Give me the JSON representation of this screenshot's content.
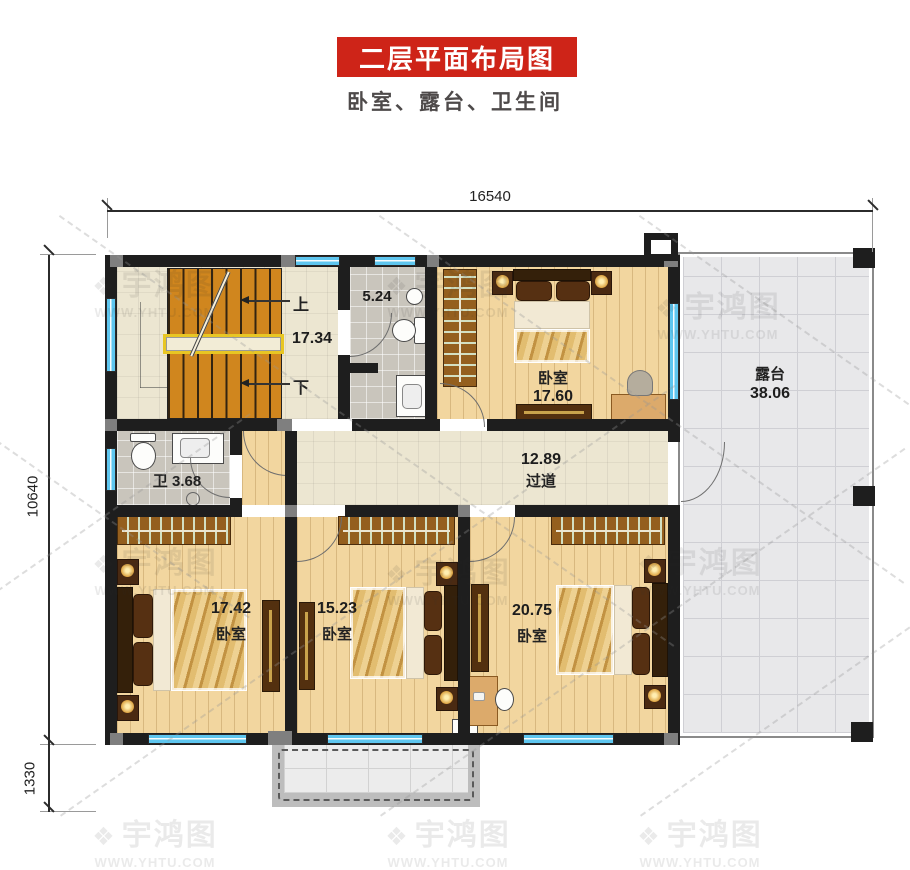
{
  "header": {
    "title": "二层平面布局图",
    "subtitle": "卧室、露台、卫生间"
  },
  "dimensions": {
    "top_width": "16540",
    "left_height_main": "10640",
    "left_height_lower": "1330"
  },
  "stairs": {
    "area": "17.34",
    "up_label": "上",
    "down_label": "下"
  },
  "bath_top": {
    "area": "5.24"
  },
  "bedroom_top": {
    "name": "卧室",
    "area": "17.60"
  },
  "terrace": {
    "name": "露台",
    "area": "38.06"
  },
  "bath_left": {
    "name": "卫",
    "area": "3.68"
  },
  "hallway": {
    "name": "过道",
    "area": "12.89"
  },
  "bedroom_left": {
    "name": "卧室",
    "area": "17.42"
  },
  "bedroom_mid": {
    "name": "卧室",
    "area": "15.23"
  },
  "bedroom_right": {
    "name": "卧室",
    "area": "20.75"
  },
  "watermark": {
    "logo_icon": "❖",
    "name": "宇鸿图",
    "url": "WWW.YHTU.COM"
  },
  "colors": {
    "accent_red": "#ce2418",
    "window_blue": "#5ec6ef",
    "stair_orange": "#d0861e",
    "wall_black": "#1e1e1e",
    "wood_floor": "#f2d69f",
    "tile_beige": "#ece6d1",
    "tile_gray": "#c9c5bc",
    "terrace_gray": "#e8e8ea"
  }
}
